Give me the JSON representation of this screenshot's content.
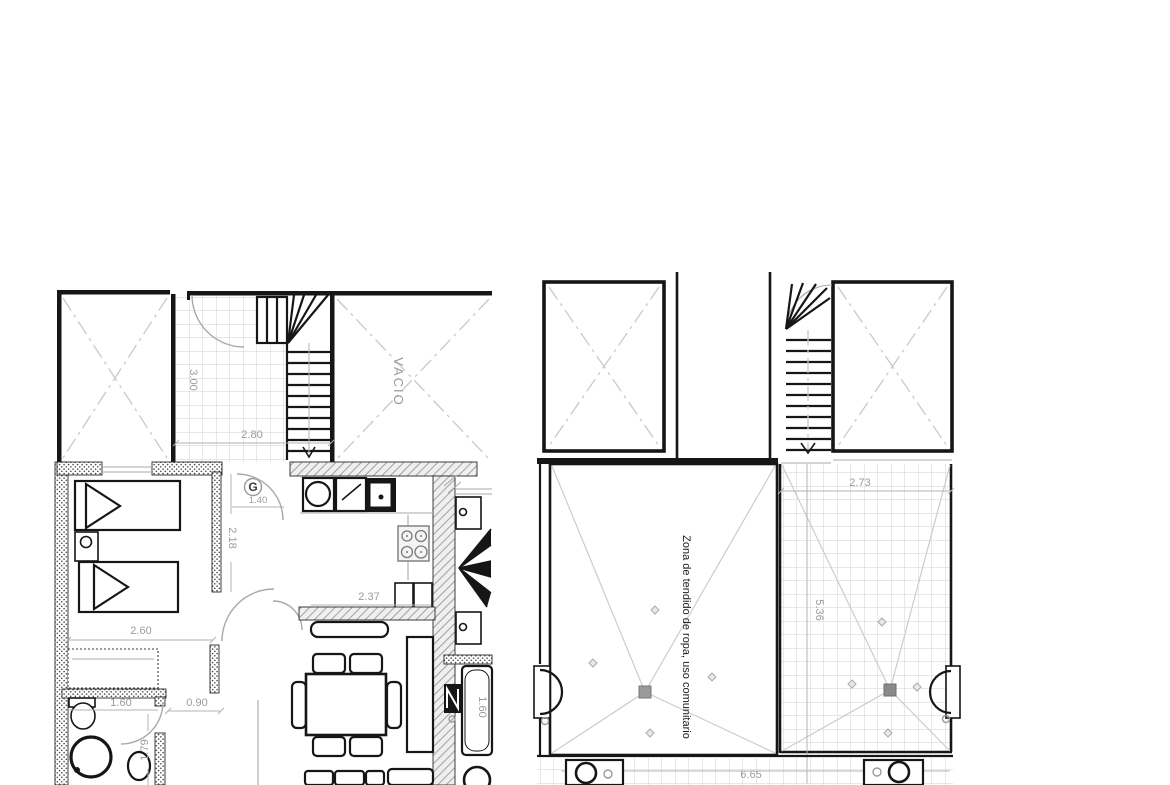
{
  "drawing": {
    "kind": "floor-plan",
    "colors": {
      "wall": "#161616",
      "dimension_text": "#9b9b9b",
      "tile_grid": "#d2d2d2",
      "void_dashdot": "#c9c9c9",
      "door_arc": "#a9a9a9",
      "drain": "#8a8a8a",
      "background": "#ffffff"
    },
    "left_plan": {
      "labels": {
        "void": "VACIO",
        "gas": "G"
      },
      "dims": {
        "landing_depth": "3.00",
        "stair_width": "2.80",
        "entry_width": "1.40",
        "hall_depth": "2.18",
        "bedroom_width": "2.60",
        "bath_width": "1.60",
        "hall_width": "0.90",
        "bath_depth": "1.79",
        "kitchen_width": "2.37",
        "bathtub_length": "1.60"
      }
    },
    "right_plan": {
      "labels": {
        "drying_zone": "Zona de tendido de ropa, uso comunitario"
      },
      "dims": {
        "terrace_width": "2.73",
        "terrace_depth": "5.36",
        "walkway_length": "6.65"
      }
    }
  }
}
